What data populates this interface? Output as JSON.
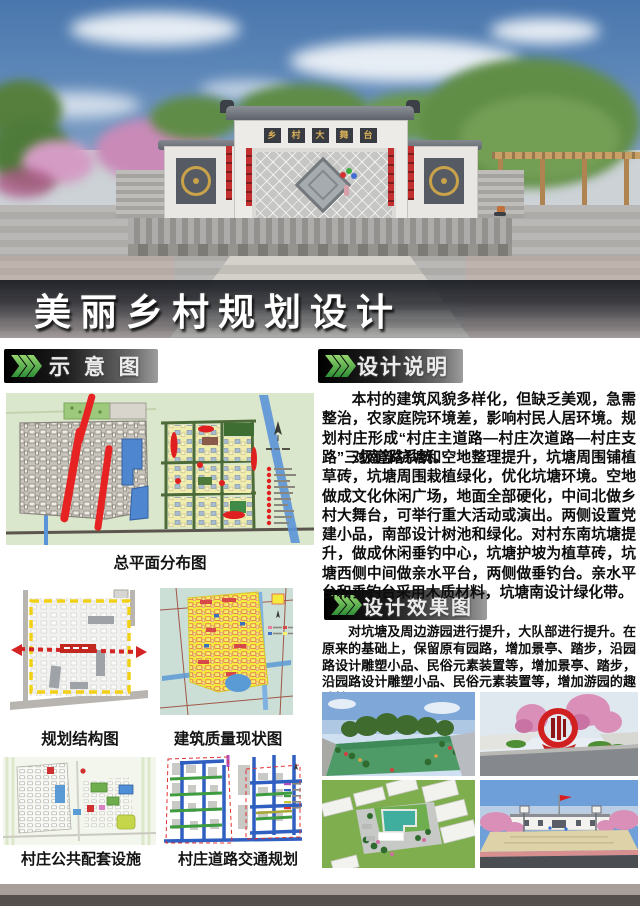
{
  "title": "美丽乡村规划设计",
  "hero": {
    "stage_sign": "乡村大舞台",
    "sign_chars": [
      "乡",
      "村",
      "大",
      "舞",
      "台"
    ]
  },
  "sections": {
    "schematic_header": "示 意 图",
    "description_header": "设计说明",
    "effects_header": "设计效果图"
  },
  "description": {
    "para1": "本村的建筑风貌多样化，但缺乏美观，急需整治，农家庭院环境差，影响村民人居环境。规划村庄形成“村庄主道路—村庄次道路—村庄支路”三级道路系统。",
    "para2": "对南部坑塘和空地整理提升，坑塘周围铺植草砖，坑塘周围栽植绿化，优化坑塘环境。空地做成文化休闲广场，地面全部硬化，中间北做乡村大舞台，可举行重大活动或演出。两侧设置党建小品，南部设计树池和绿化。对村东南坑塘提升，做成休闲垂钓中心，坑塘护坡为植草砖，坑塘西侧中间做亲水平台，两侧做垂钓台。亲水平台和垂钓台采用木质材料，坑塘南设计绿化带。"
  },
  "effects": {
    "para": "对坑塘及周边游园进行提升，大队部进行提升。在原来的基础上，保留原有园路，增加景亭、踏步，沿园路设计雕塑小品、民俗元素装置等，增加景亭、踏步，沿园路设计雕塑小品、民俗元素装置等，增加游园的趣味性。",
    "images": [
      "pond-fishing-center-render",
      "folk-monument-render",
      "courtyard-aerial-render",
      "basketball-court-render"
    ]
  },
  "maps": {
    "master_plan_caption": "总平面分布图",
    "structure_caption": "规划结构图",
    "building_quality_caption": "建筑质量现状图",
    "facilities_caption": "村庄公共配套设施",
    "traffic_caption": "村庄道路交通规划"
  },
  "colors": {
    "chevron_green": "#3f9b3f",
    "road_red": "#e02424",
    "water_blue": "#4f8fd8",
    "plan_yellow": "#f2eca8",
    "map_bg_green": "#dbe7cc",
    "boundary_dash_yellow": "#f2d41c",
    "axis_dash_red": "#d42424",
    "traffic_road_blue": "#2f5fc0",
    "title_band_dark": "#1e2128",
    "footer_light": "#a89f9a",
    "footer_dark": "#55504b"
  }
}
